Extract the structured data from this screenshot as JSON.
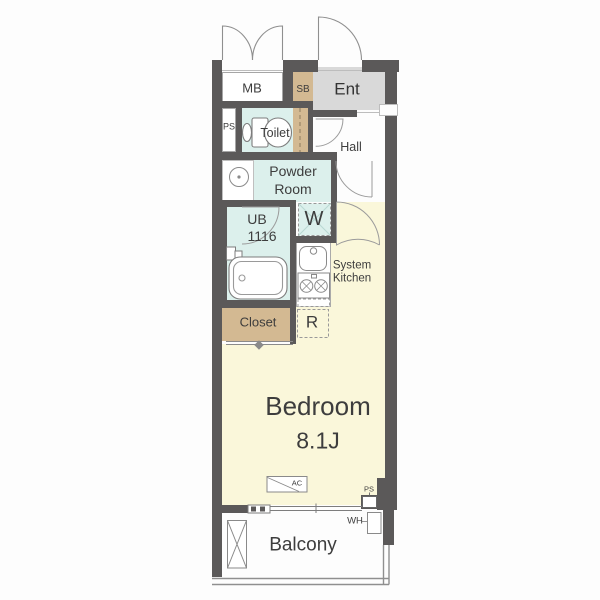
{
  "plan": {
    "type": "apartment-floor-plan",
    "rooms": {
      "meter_box": "MB",
      "shoe_box": "SB",
      "entrance": "Ent",
      "pipe_space_top": "PS",
      "toilet": "Toilet",
      "hall": "Hall",
      "powder_room_line1": "Powder",
      "powder_room_line2": "Room",
      "washer": "W",
      "unit_bath_line1": "UB",
      "unit_bath_line2": "1116",
      "kitchen_line1": "System",
      "kitchen_line2": "Kitchen",
      "closet": "Closet",
      "refrigerator": "R",
      "bedroom": "Bedroom",
      "bedroom_size": "8.1J",
      "air_conditioner": "AC",
      "pipe_space_bottom": "PS",
      "water_heater": "WH",
      "balcony": "Balcony"
    },
    "colors": {
      "wall": "#5b5959",
      "floor_yellow": "#faf7da",
      "wet_area_cyan": "#dcf0ec",
      "storage_tan": "#d3b992",
      "entrance_gray": "#d9d9d9",
      "text": "#3d3d3d"
    }
  }
}
